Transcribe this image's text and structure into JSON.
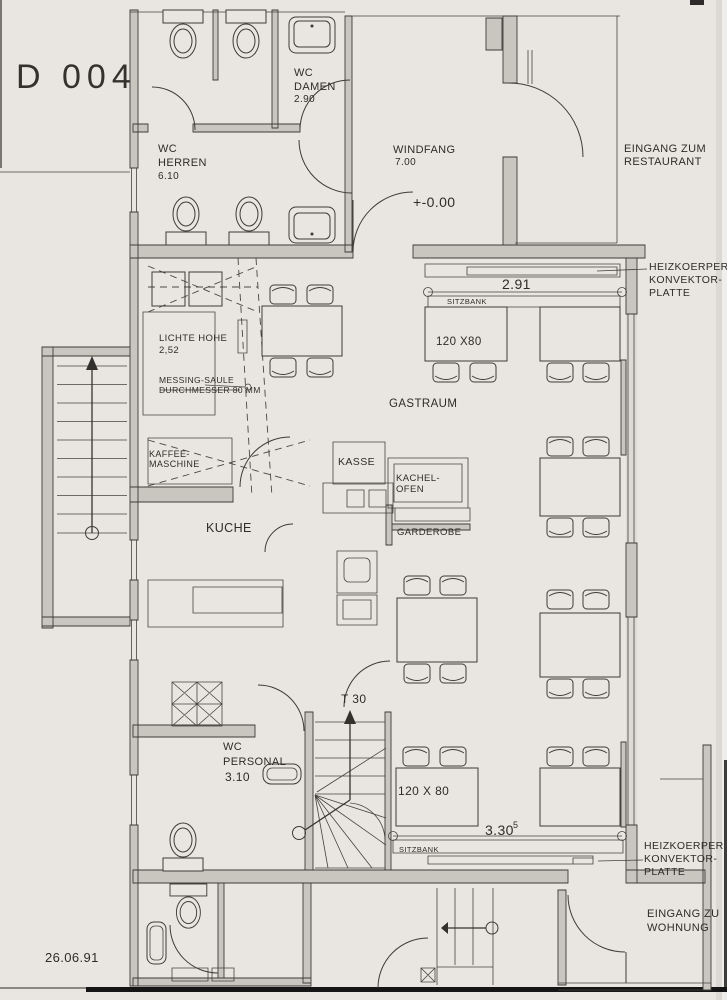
{
  "sheet": {
    "number": "D 004",
    "date": "26.06.91"
  },
  "rooms": {
    "wc_herren": {
      "line1": "WC",
      "line2": "HERREN",
      "area": "6.10"
    },
    "wc_damen": {
      "line1": "WC",
      "line2": "DAMEN",
      "area": "2.90"
    },
    "windfang": {
      "name": "WINDFANG",
      "area": "7.00"
    },
    "gastraum": {
      "name": "GASTRAUM"
    },
    "kueche": {
      "name": "KUCHE"
    },
    "wc_personal": {
      "line1": "WC",
      "line2": "PERSONAL",
      "area": "3.10"
    }
  },
  "entrances": {
    "restaurant": {
      "line1": "EINGANG ZUM",
      "line2": "RESTAURANT"
    },
    "wohnung": {
      "line1": "EINGANG ZU",
      "line2": "WOHNUNG"
    }
  },
  "heaters": {
    "top": {
      "line1": "HEIZKOERPER",
      "line2": "KONVEKTOR-",
      "line3": "PLATTE"
    },
    "bottom": {
      "line1": "HEIZKOERPER",
      "line2": "KONVEKTOR-",
      "line3": "PLATTE"
    }
  },
  "annotations": {
    "level": "+-0.00",
    "clear_height_line1": "LICHTE HOHE",
    "clear_height_line2": "2,52",
    "column_line1": "MESSING-SAULE",
    "column_line2": "DURCHMESSER 80 MM",
    "coffee_line1": "KAFFEE-",
    "coffee_line2": "MASCHINE",
    "kasse": "KASSE",
    "stove_line1": "KACHEL-",
    "stove_line2": "OFEN",
    "garderobe": "GARDEROBE",
    "bench_top": "SITZBANK",
    "bench_bottom": "SITZBANK",
    "table_top": "120 X80",
    "table_bottom": "120 X 80",
    "door": "T 30"
  },
  "dimensions": {
    "top": "2.91",
    "bottom": "3.30",
    "bottom_sup": "5"
  }
}
